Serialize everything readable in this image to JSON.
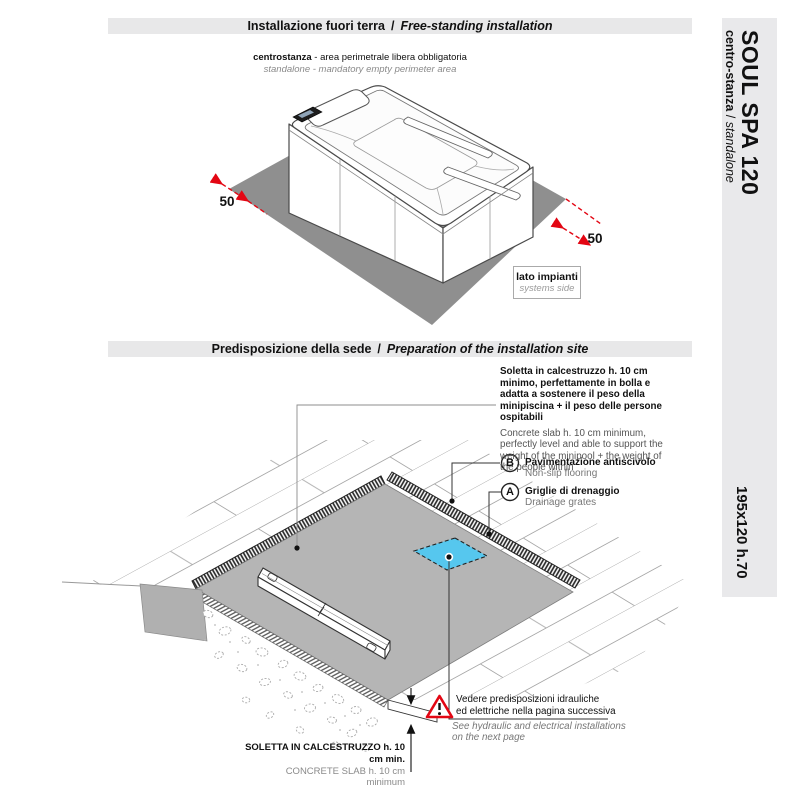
{
  "header1": {
    "it": "Installazione fuori terra",
    "sep": "/",
    "en": "Free-standing installation"
  },
  "caption": {
    "it_bold": "centrostanza",
    "it_rest": " - area perimetrale libera obbligatoria",
    "en": "standalone - mandatory empty perimeter area"
  },
  "sidebar": {
    "title": "SOUL SPA 120",
    "sub_bold": "centro-stanza",
    "sub_sep": " / ",
    "sub_italic": "standalone",
    "size": "195x120 h.70"
  },
  "upper_diagram": {
    "dim_left": "50",
    "dim_right": "50",
    "systems_label": {
      "it": "lato impianti",
      "en": "systems side"
    }
  },
  "header2": {
    "it": "Predisposizione della sede",
    "sep": "/",
    "en": "Preparation of the installation site"
  },
  "site_prep": {
    "slab_note_it": "Soletta in calcestruzzo h. 10 cm minimo, perfettamente in bolla e adatta a sostenere il peso della minipiscina + il peso delle persone ospitabili",
    "slab_note_en": "Concrete slab h. 10 cm minimum, perfectly level and able to support the weight of the minipool + the weight of the people within",
    "callouts": [
      {
        "letter": "B",
        "it": "Pavimentazione antiscivolo",
        "en": "Non-slip flooring"
      },
      {
        "letter": "A",
        "it": "Griglie di drenaggio",
        "en": "Drainage grates"
      }
    ],
    "warning": {
      "it1": "Vedere predisposizioni idrauliche",
      "it2": "ed elettriche nella pagina successiva",
      "en1": "See hydraulic and electrical installations",
      "en2": "on the next page"
    },
    "slab_caption": {
      "it": "SOLETTA IN CALCESTRUZZO  h. 10 cm min.",
      "en": "CONCRETE SLAB  h. 10 cm minimum"
    }
  },
  "colors": {
    "accent_red": "#e30613",
    "slab_dark": "#8f8f8f",
    "slab_light": "#b5b5b5",
    "drain_blue": "#56c7ee",
    "panel_gray": "#e8e8e9"
  }
}
